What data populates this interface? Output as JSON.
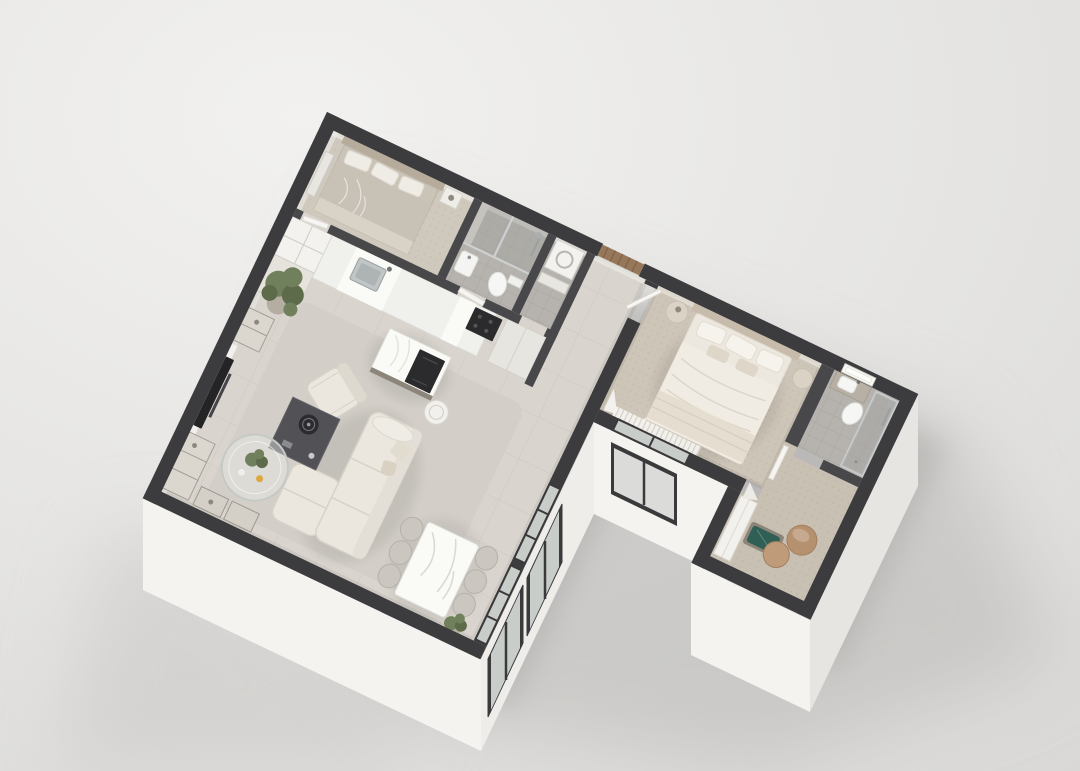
{
  "scene": {
    "label": "Photorealistic 3D axonometric floor-plan render of an L-shaped one-bedroom apartment on a gray studio background"
  },
  "palette": {
    "bg_top": "#f2f1ef",
    "bg_mid": "#e4e3e1",
    "bg_bottom": "#d5d4d2",
    "shadow": "#b9b8b6",
    "wall": "#3c3c3f",
    "wall_int": "#48484b",
    "plinth_bright": "#fbfaf8",
    "plinth_light": "#f4f3f0",
    "plinth_mid": "#eeedea",
    "plinth_shade": "#e6e5e1",
    "floor": "#d9d5ce",
    "rug": "#d3cfc7",
    "carpet_bed": "#cfc8bc",
    "carpet_master": "#cdc5b7",
    "carpet_dress": "#c8c0b2",
    "tile": "#b6b3ae",
    "tile_dark": "#a5a4a0",
    "white_furn": "#f2f0ec",
    "cream": "#ebe7df",
    "cream_shade": "#d7d2c7",
    "duvet_gray": "#c8c1b5",
    "duvet_white": "#ece7df",
    "wood": "#97775a",
    "marble": "#fafaf7",
    "steel": "#c0c5c5",
    "dark_furn": "#515156",
    "tv": "#242427",
    "cooktop": "#2b2b2d",
    "glass": "#c9cdca",
    "frame": "#3a3a3c",
    "plant_green": "#71805c",
    "plant_dark": "#5d6b4b",
    "cushion_green": "#2f5f55",
    "pouf_tan": "#b6916f",
    "accent_yellow": "#dca83f",
    "mirror_glow": "#fdfdfa"
  },
  "building": {
    "shape": "L-shaped single floor, cut-away walls, viewed from above at an angle",
    "rooms": [
      {
        "name": "second-bedroom",
        "items": [
          "double-bed",
          "pillows",
          "leaning-mirror",
          "nightstand"
        ]
      },
      {
        "name": "bathroom",
        "items": [
          "walk-in-shower",
          "toilet",
          "washbasin",
          "glass-partition"
        ]
      },
      {
        "name": "laundry-wc",
        "items": [
          "washing-machine",
          "small-counter"
        ]
      },
      {
        "name": "entry-hallway",
        "items": [
          "wooden-entry-door"
        ]
      },
      {
        "name": "kitchen",
        "items": [
          "wall-counter",
          "steel-sink",
          "cooktop",
          "marble-island",
          "tall-cabinets",
          "open-shelf-cubes",
          "curved-stool"
        ]
      },
      {
        "name": "living-room",
        "items": [
          "sofa-with-chaise",
          "armchair",
          "ottoman",
          "round-glass-coffee-table",
          "dark-media-cabinet-with-speaker",
          "tv-wall",
          "shelving-units",
          "potted-plant",
          "area-rug"
        ]
      },
      {
        "name": "dining-area",
        "items": [
          "marble-dining-table",
          "six-chairs",
          "potted-plant",
          "two-windows"
        ]
      },
      {
        "name": "master-bedroom",
        "items": [
          "double-bed",
          "two-round-nightstands",
          "carpet",
          "window-with-curtains",
          "open-door"
        ]
      },
      {
        "name": "master-bathroom",
        "items": [
          "vanity-with-sink",
          "backlit-mirror",
          "toilet",
          "glass-shower"
        ]
      },
      {
        "name": "walk-in-closet",
        "items": [
          "wardrobe",
          "bench-with-green-cushion",
          "two-round-poufs",
          "leaning-mirror"
        ]
      }
    ]
  }
}
